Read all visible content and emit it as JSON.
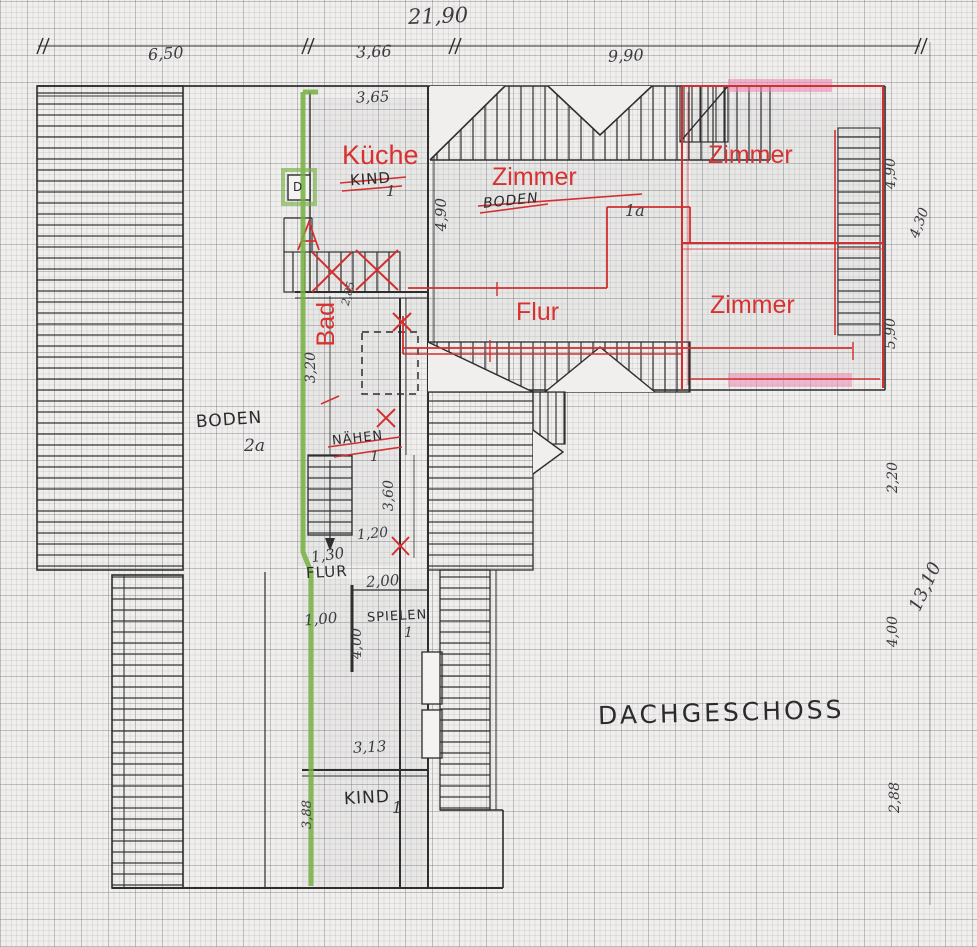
{
  "title": "DACHGESCHOSS",
  "rooms": {
    "kueche": "Küche",
    "zimmer_center": "Zimmer",
    "zimmer_top_right": "Zimmer",
    "zimmer_bottom_right": "Zimmer",
    "flur": "Flur",
    "bad": "Bad"
  },
  "struck_labels": {
    "kind_top": "KIND",
    "kind_top_num": "1",
    "boden1a": "BODEN",
    "boden1a_num": "1a",
    "naehen": "NÄHEN",
    "naehen_num": "1"
  },
  "labels": {
    "boden2a": "BODEN",
    "boden2a_num": "2a",
    "flur_small": "FLUR",
    "spielen": "SPIELEN",
    "spielen_num": "1",
    "kind_bottom": "KIND",
    "kind_bottom_num": "1",
    "stove": "D"
  },
  "dimensions": {
    "total_width": "21,90",
    "seg_left": "6,50",
    "seg_mid": "3,66",
    "seg_right": "9,90",
    "kueche_width": "3,65",
    "kueche_depth": "4,90",
    "stair_width": "2,85",
    "bad_height": "3,20",
    "shaft_height": "3,60",
    "niche": "1,20",
    "flur_width": "1,30",
    "flur_lower": "1,00",
    "spielen_width": "2,00",
    "spielen_depth": "4,00",
    "kind_width": "3,13",
    "kind_side": "3,88",
    "right_1": "4,90",
    "right_2": "4,30",
    "right_3": "5,90",
    "right_4": "2,20",
    "right_total": "13,10",
    "right_5": "4,00",
    "right_6": "2,88"
  },
  "colors": {
    "red": "#d93030",
    "green": "#76b041",
    "pink": "#ee7fae",
    "ink": "#2e2e2e"
  }
}
